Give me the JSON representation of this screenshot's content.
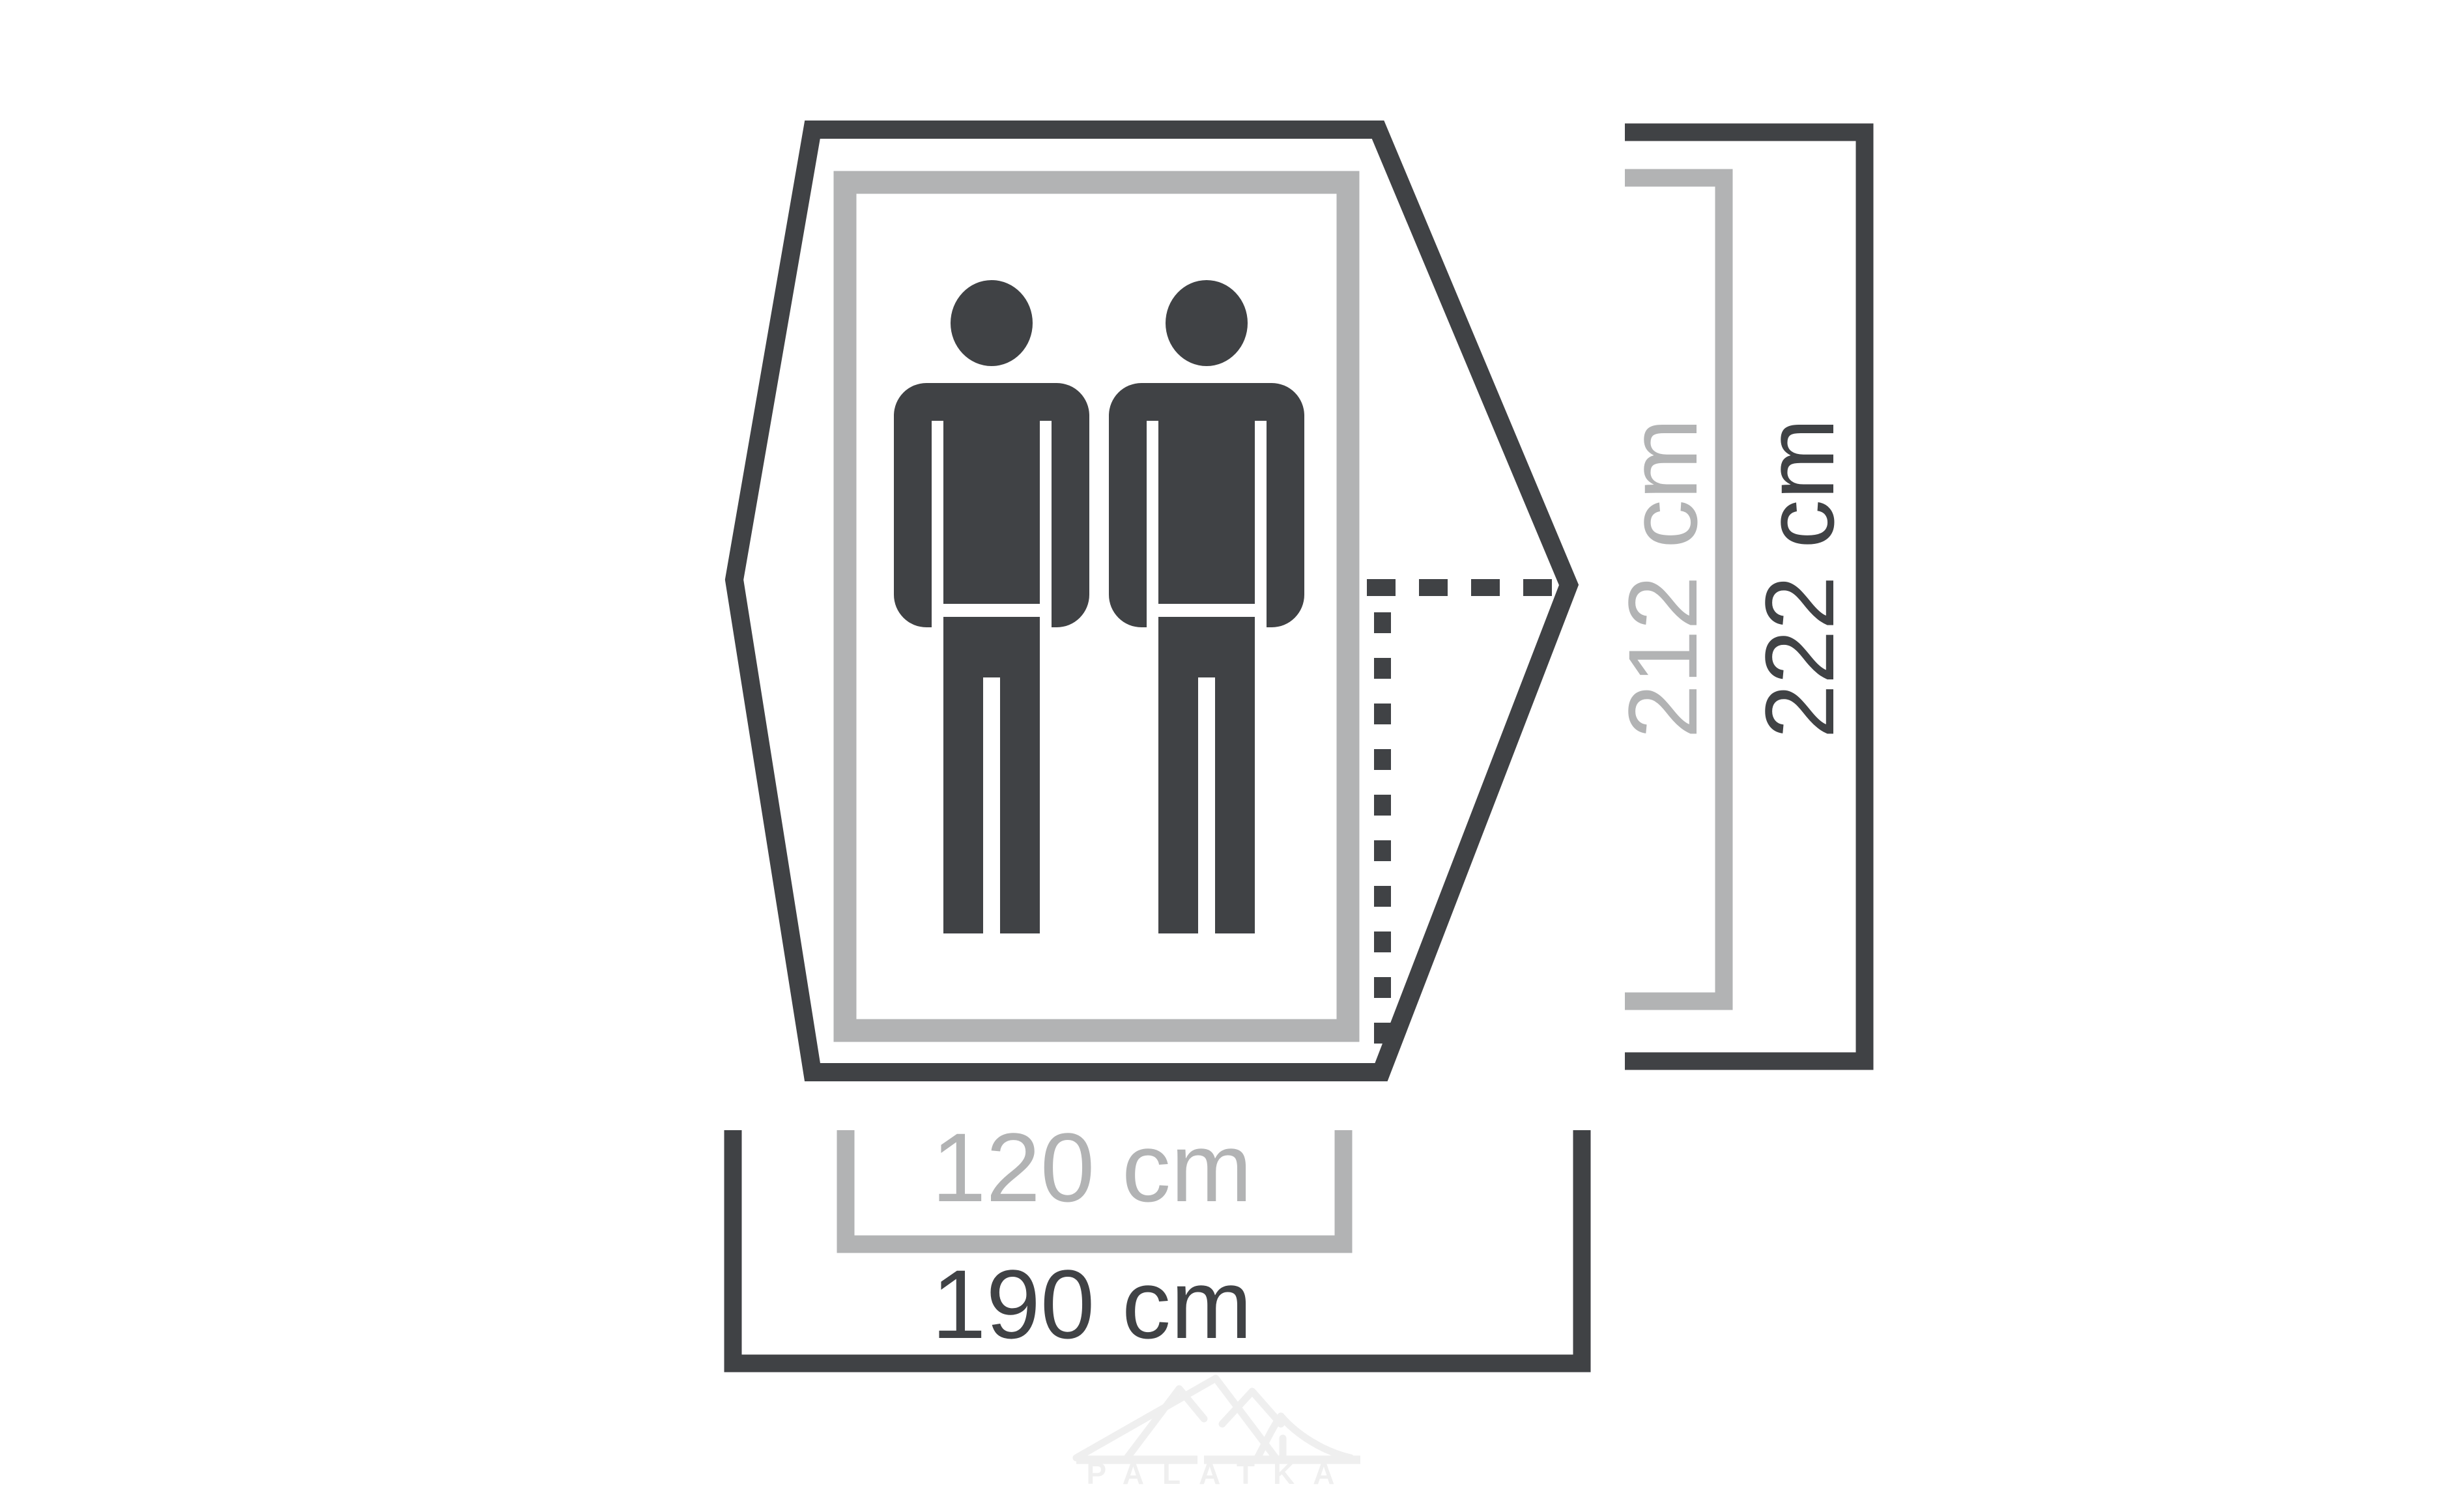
{
  "diagram": {
    "person_count": 2,
    "dimension_labels": {
      "inner_length": "212 cm",
      "outer_length": "222 cm",
      "inner_width": "120 cm",
      "outer_width": "190 cm"
    },
    "watermark_text": "PALATKA",
    "colors": {
      "dark": "#404245",
      "light": "#b2b3b4",
      "wm": "#efefef",
      "bg": "#ffffff"
    }
  }
}
